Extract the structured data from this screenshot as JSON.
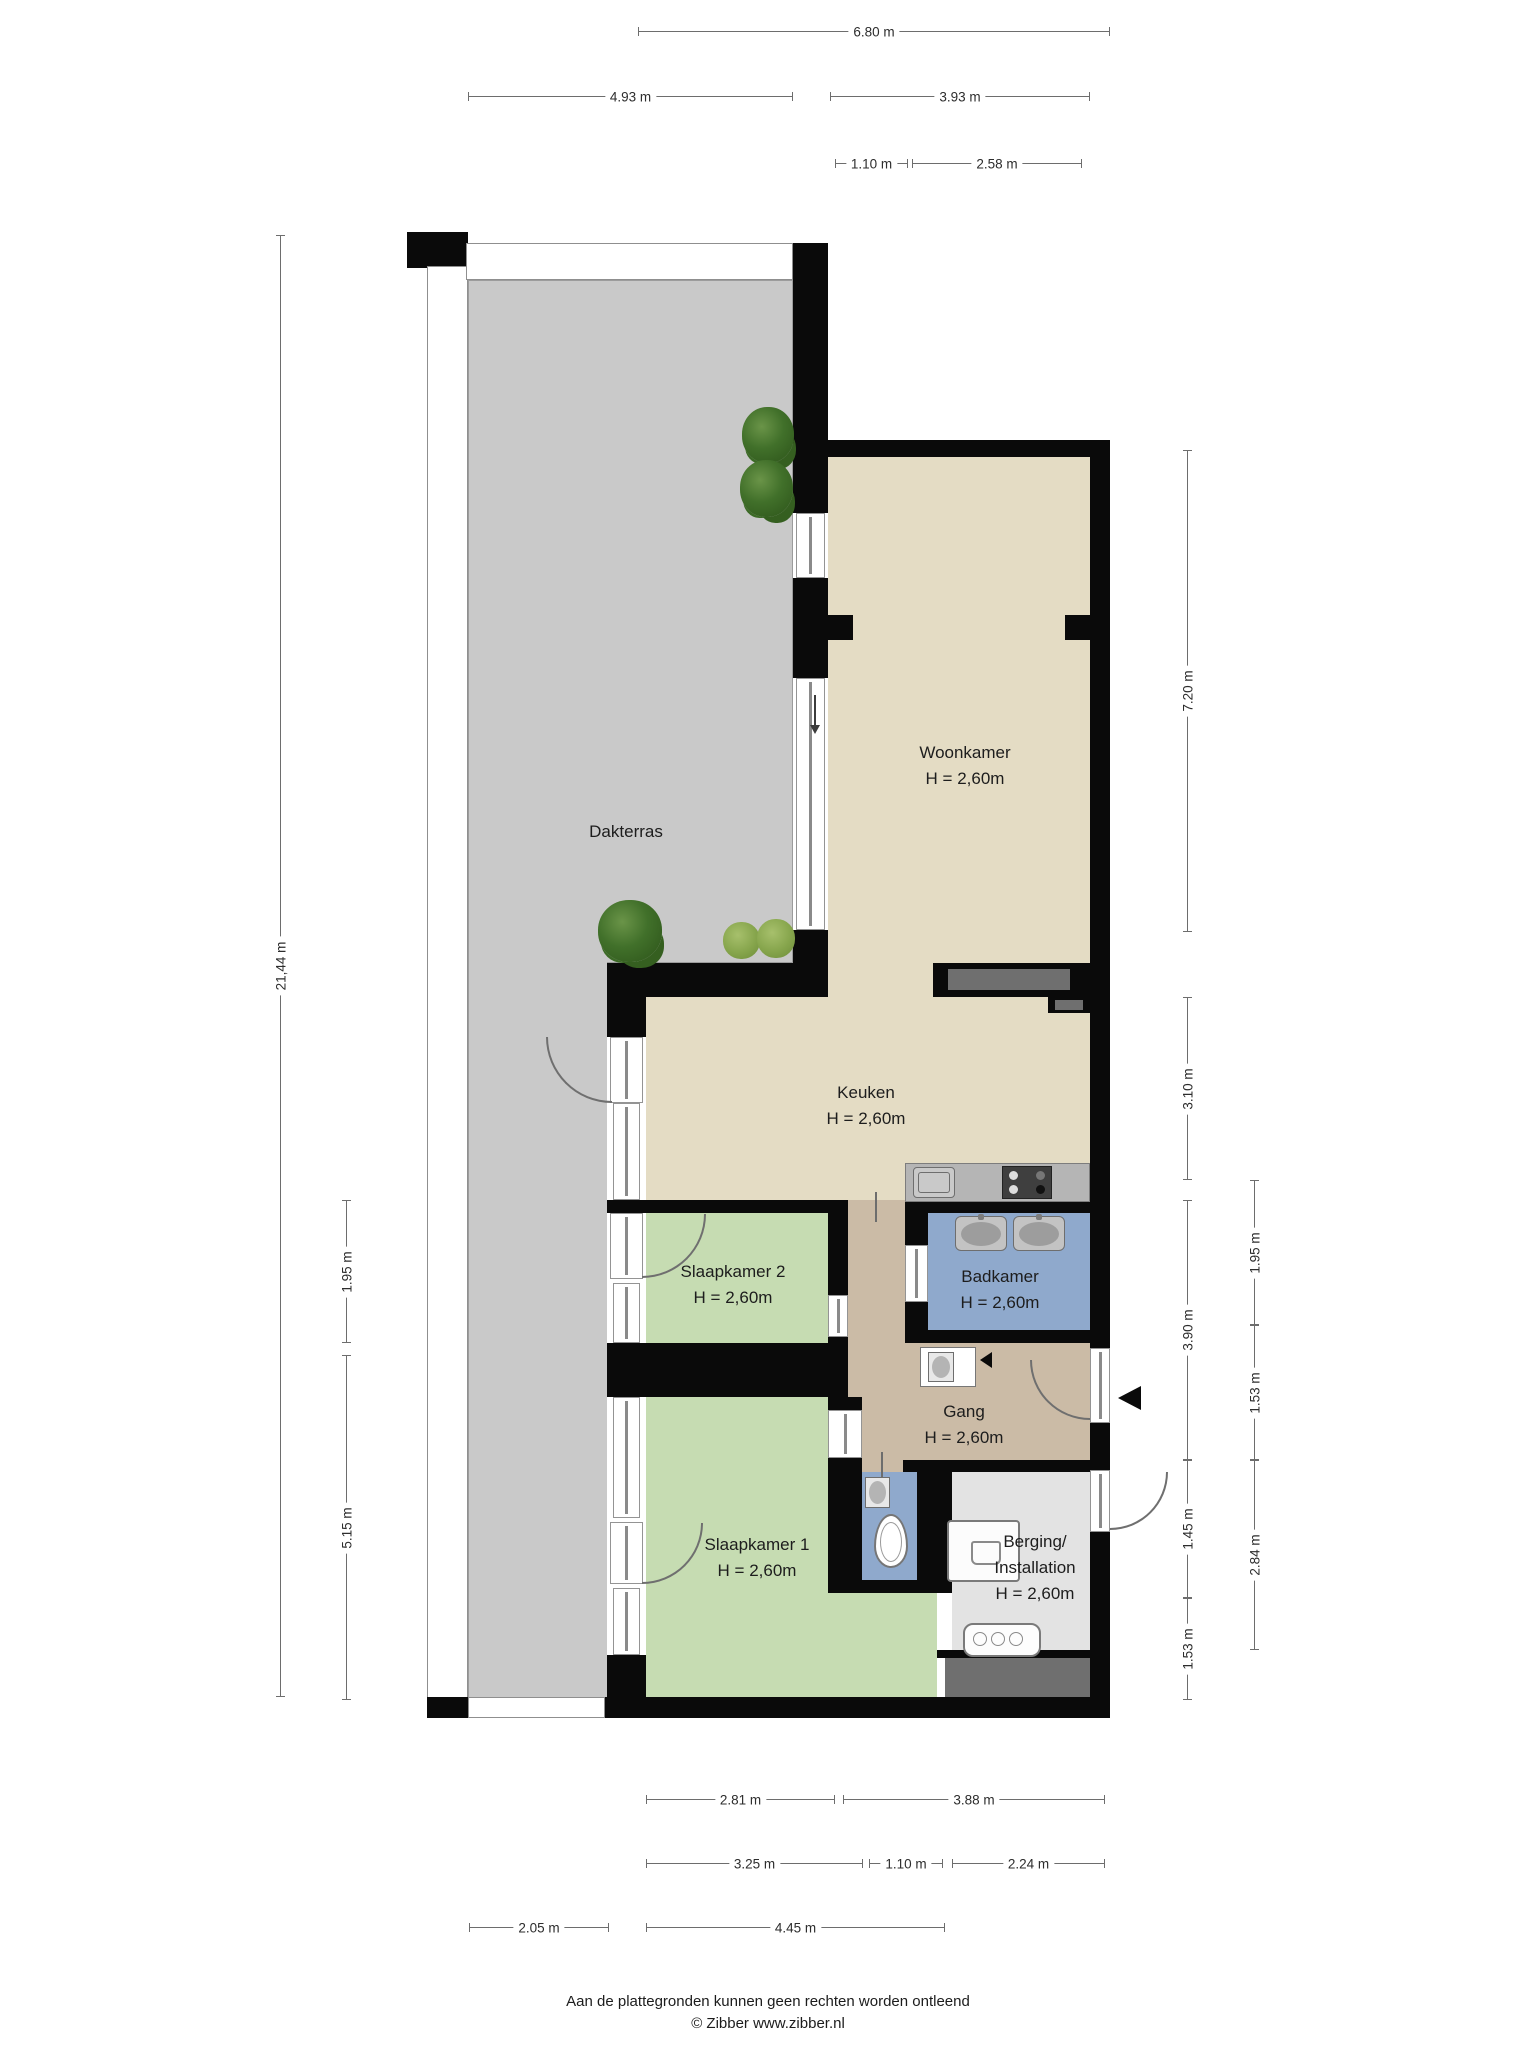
{
  "title": "Floor plan (plattegrond)",
  "colors": {
    "wall": "#0a0a0a",
    "terrace_floor": "#c9c9c9",
    "living_floor": "#e4dcc4",
    "bedroom_floor": "#c6dcb2",
    "bathroom_floor": "#8fa9cc",
    "hallway_floor": "#cbbba6",
    "storage_floor": "#e3e3e3",
    "niche_dark": "#6f6f6f"
  },
  "rooms": [
    {
      "id": "dakterras",
      "name": "Dakterras",
      "height": "",
      "cx": 626,
      "cy": 832
    },
    {
      "id": "woonkamer",
      "name": "Woonkamer",
      "height": "H = 2,60m",
      "cx": 965,
      "cy": 766
    },
    {
      "id": "keuken",
      "name": "Keuken",
      "height": "H = 2,60m",
      "cx": 866,
      "cy": 1106
    },
    {
      "id": "slaapkamer2",
      "name": "Slaapkamer 2",
      "height": "H = 2,60m",
      "cx": 733,
      "cy": 1285
    },
    {
      "id": "badkamer",
      "name": "Badkamer",
      "height": "H = 2,60m",
      "cx": 1000,
      "cy": 1290
    },
    {
      "id": "gang",
      "name": "Gang",
      "height": "H = 2,60m",
      "cx": 964,
      "cy": 1425
    },
    {
      "id": "slaapkamer1",
      "name": "Slaapkamer 1",
      "height": "H = 2,60m",
      "cx": 757,
      "cy": 1558
    },
    {
      "id": "berging",
      "name": "Berging/",
      "name2": "Installation",
      "height": "H = 2,60m",
      "cx": 1035,
      "cy": 1568
    }
  ],
  "dimensions": [
    {
      "label": "6.80 m",
      "orient": "h",
      "x1": 638,
      "x2": 1110,
      "y": 32
    },
    {
      "label": "4.93 m",
      "orient": "h",
      "x1": 468,
      "x2": 793,
      "y": 97
    },
    {
      "label": "3.93 m",
      "orient": "h",
      "x1": 830,
      "x2": 1090,
      "y": 97
    },
    {
      "label": "1.10 m",
      "orient": "h",
      "x1": 835,
      "x2": 908,
      "y": 164
    },
    {
      "label": "2.58 m",
      "orient": "h",
      "x1": 912,
      "x2": 1082,
      "y": 164
    },
    {
      "label": "21,44 m",
      "orient": "v",
      "y1": 235,
      "y2": 1697,
      "x": 281
    },
    {
      "label": "1.95 m",
      "orient": "v",
      "y1": 1200,
      "y2": 1343,
      "x": 347
    },
    {
      "label": "5.15 m",
      "orient": "v",
      "y1": 1355,
      "y2": 1700,
      "x": 347
    },
    {
      "label": "7.20 m",
      "orient": "v",
      "y1": 450,
      "y2": 932,
      "x": 1188
    },
    {
      "label": "3.10 m",
      "orient": "v",
      "y1": 997,
      "y2": 1180,
      "x": 1188
    },
    {
      "label": "3.90 m",
      "orient": "v",
      "y1": 1200,
      "y2": 1460,
      "x": 1188
    },
    {
      "label": "1.45 m",
      "orient": "v",
      "y1": 1460,
      "y2": 1598,
      "x": 1188
    },
    {
      "label": "1.53 m",
      "orient": "v",
      "y1": 1598,
      "y2": 1700,
      "x": 1188
    },
    {
      "label": "1.95 m",
      "orient": "v",
      "y1": 1180,
      "y2": 1325,
      "x": 1255
    },
    {
      "label": "1.53 m",
      "orient": "v",
      "y1": 1325,
      "y2": 1460,
      "x": 1255
    },
    {
      "label": "2.84 m",
      "orient": "v",
      "y1": 1460,
      "y2": 1650,
      "x": 1255
    },
    {
      "label": "2.81 m",
      "orient": "h",
      "x1": 646,
      "x2": 835,
      "y": 1800
    },
    {
      "label": "3.88 m",
      "orient": "h",
      "x1": 843,
      "x2": 1105,
      "y": 1800
    },
    {
      "label": "3.25 m",
      "orient": "h",
      "x1": 646,
      "x2": 863,
      "y": 1864
    },
    {
      "label": "1.10 m",
      "orient": "h",
      "x1": 869,
      "x2": 943,
      "y": 1864
    },
    {
      "label": "2.24 m",
      "orient": "h",
      "x1": 952,
      "x2": 1105,
      "y": 1864
    },
    {
      "label": "2.05 m",
      "orient": "h",
      "x1": 469,
      "x2": 609,
      "y": 1928
    },
    {
      "label": "4.45 m",
      "orient": "h",
      "x1": 646,
      "x2": 945,
      "y": 1928
    }
  ],
  "footer": {
    "disclaimer": "Aan de plattegronden kunnen geen rechten worden ontleend",
    "copyright": "© Zibber www.zibber.nl"
  }
}
